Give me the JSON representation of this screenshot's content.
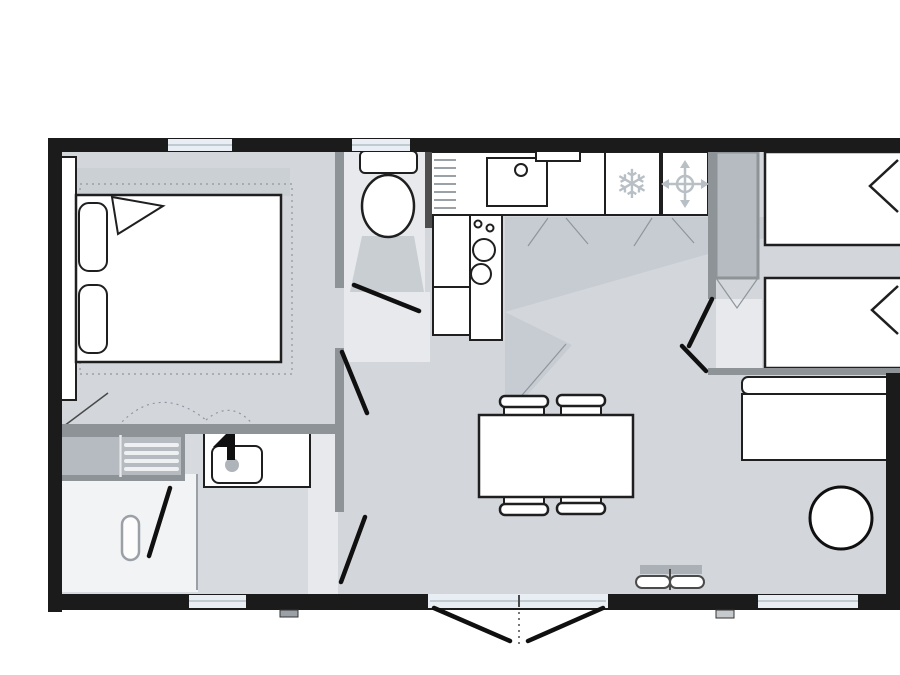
{
  "meta": {
    "kind": "mobile-home-floor-plan",
    "width_px": 900,
    "height_px": 675,
    "visible_text": "none"
  },
  "colors": {
    "wall": "#1b1b1b",
    "partition": "#8e9398",
    "partition_dark": "#4e4e4e",
    "floor": "#d3d7dc",
    "floor_light": "#e7e9ec",
    "bath_floor": "#d7dade",
    "shade": "#c7ccd2",
    "shade_line": "#8e959c",
    "fixture_fill": "#ffffff",
    "fixture_stroke": "#1f1f1f",
    "door": "#101010",
    "window_fill": "#e8eef3",
    "window_frame": "#a9b5bd",
    "cabinet": "#b5bbc0",
    "cabinet_stripe": "#eef0f2",
    "icon": "#b8bfc5",
    "shower": "#f2f3f5"
  },
  "icons": {
    "snowflake": {
      "name": "snowflake-icon",
      "glyph": "❄"
    },
    "valve": {
      "name": "valve-compass-icon"
    },
    "faucet": {
      "name": "faucet-icon"
    }
  },
  "rooms": [
    {
      "name": "master-bedroom",
      "furniture": [
        "double-bed",
        "headboard",
        "pillow x2",
        "turned-sheet",
        "dashed-rug"
      ]
    },
    {
      "name": "wc",
      "furniture": [
        "toilet"
      ]
    },
    {
      "name": "kitchen",
      "furniture": [
        "drainer",
        "sink",
        "counter",
        "fridge-freezer",
        "water-heater",
        "cooktop-2-burners",
        "base-cabinets"
      ]
    },
    {
      "name": "living-dining",
      "furniture": [
        "dining-table",
        "chair x4",
        "wall-heater",
        "french-doors"
      ]
    },
    {
      "name": "bathroom",
      "furniture": [
        "storage-cabinet",
        "shelf-unit",
        "washbasin",
        "shower"
      ]
    },
    {
      "name": "twin-bedroom",
      "furniture": [
        "single-bed x2",
        "wardrobe"
      ]
    },
    {
      "name": "lounge-bedroom",
      "furniture": [
        "bench-seat",
        "round-table"
      ]
    }
  ],
  "openings": {
    "windows_top": 2,
    "windows_bottom": 2,
    "french_door_bottom": 1,
    "interior_doors": [
      "wc-door",
      "master-bedroom-door",
      "twin-bedroom-door",
      "lounge-door",
      "bathroom-door",
      "shower-door"
    ]
  },
  "counts": {
    "chairs": 4,
    "burners": 2,
    "single_beds": 2,
    "double_beds": 1,
    "round_tables": 1
  }
}
